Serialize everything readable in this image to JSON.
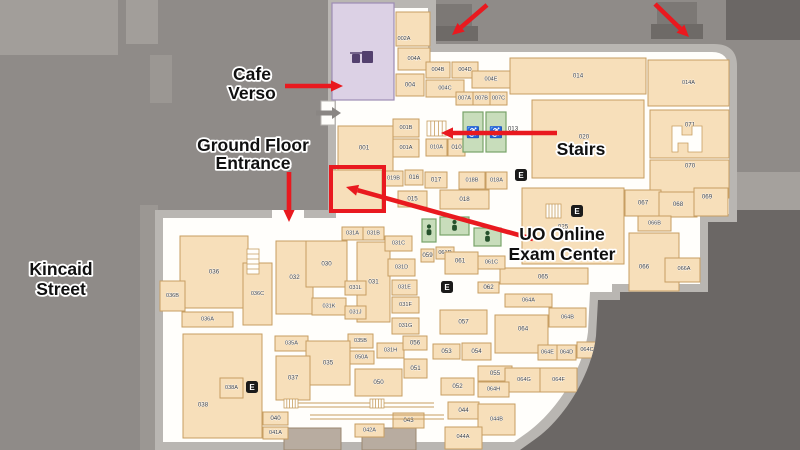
{
  "map": {
    "colors": {
      "street": "#8f8b88",
      "street_light": "#a29e9a",
      "sidewalk": "#9b9793",
      "dark": "#6b6765",
      "elbow": "#a5a19d",
      "wall": "#b9b6b2",
      "floor": "#fffefb",
      "room": "#f7dfba",
      "room_stroke": "#c79e62",
      "cafe": "#dcd1e5",
      "cafe_stroke": "#9d8cb5",
      "cafe_icon": "#53406e",
      "green": "#c8ddbb",
      "green_stroke": "#78a369",
      "green_icon": "#25512c",
      "dim": "#b8aca0",
      "dim_stroke": "#9b8871",
      "red": "#e9191f",
      "ink": "#101010",
      "room_ink": "#3c3c3c",
      "stoop_top": "#7c7875",
      "stoop_base": "#6e6a67",
      "gray_arrow": "#8a8683",
      "elevator": "#1b1b1b",
      "elevator_letter": "#ffffff"
    },
    "building": {
      "wall_path": "M328,0 L436,0 L436,44 L714,44 Q737,44 737,66 L737,222 L708,222 L708,292 L620,292 L620,300 L598,300 L596,336 C592,372 566,418 534,440 L520,450 L155,450 L155,210 L328,210 Z",
      "floor_path": "M336,8 L428,8 L428,52 L712,52 Q729,52 729,70 L729,214 L700,214 L700,284 L612,284 L612,292 L590,292 L588,332 C584,366 560,408 528,432 L514,442 L163,442 L163,218 L336,218 Z",
      "entrance_gap": [
        272,
        210,
        32,
        10
      ]
    },
    "bg_shapes": [
      [
        0,
        0,
        118,
        55,
        "street_light",
        "sidewalk-block"
      ],
      [
        126,
        0,
        32,
        44,
        "street_light",
        "sidewalk-block"
      ],
      [
        150,
        55,
        22,
        48,
        "sidewalk",
        "sidewalk-strip"
      ],
      [
        140,
        205,
        18,
        245,
        "sidewalk",
        "sidewalk-strip"
      ],
      [
        737,
        172,
        63,
        40,
        "elbow",
        "sidewalk-elbow"
      ],
      [
        726,
        0,
        74,
        40,
        "dark",
        "adjacent-building"
      ],
      [
        505,
        210,
        295,
        240,
        "dark",
        "adjacent-area"
      ]
    ],
    "entrance_stoops": [
      [
        434,
        4,
        38,
        23
      ],
      [
        428,
        26,
        50,
        15
      ],
      [
        657,
        2,
        40,
        23
      ],
      [
        651,
        24,
        52,
        15
      ]
    ],
    "rooms": [
      [
        "002A",
        396,
        12,
        34,
        34,
        404,
        39
      ],
      [
        "004A",
        398,
        48,
        32,
        22
      ],
      [
        "004",
        396,
        74,
        28,
        22
      ],
      [
        "004B",
        426,
        62,
        24,
        16
      ],
      [
        "004C",
        426,
        80,
        38,
        17
      ],
      [
        "004D",
        452,
        62,
        26,
        16
      ],
      [
        "004E",
        472,
        71,
        38,
        17
      ],
      [
        "007A",
        456,
        92,
        17,
        13
      ],
      [
        "007B",
        473,
        92,
        17,
        13
      ],
      [
        "007C",
        490,
        92,
        17,
        13
      ],
      [
        "014",
        510,
        58,
        136,
        36
      ],
      [
        "014A",
        648,
        60,
        81,
        46
      ],
      [
        "020",
        532,
        100,
        112,
        78,
        584,
        137
      ],
      [
        "071",
        650,
        110,
        79,
        48,
        690,
        125
      ],
      [
        "070",
        650,
        160,
        79,
        38,
        690,
        166
      ],
      [
        "067",
        625,
        190,
        36,
        26
      ],
      [
        "068",
        659,
        192,
        38,
        25
      ],
      [
        "069",
        694,
        188,
        34,
        28,
        707,
        197
      ],
      [
        "066B",
        638,
        216,
        33,
        15
      ],
      [
        "066",
        629,
        233,
        50,
        58,
        644,
        267
      ],
      [
        "066A",
        665,
        258,
        35,
        24,
        684,
        269
      ],
      [
        "025",
        522,
        188,
        102,
        76,
        563,
        227
      ],
      [
        "065",
        500,
        268,
        88,
        16,
        543,
        277
      ],
      [
        "001",
        338,
        126,
        55,
        48,
        364,
        148
      ],
      [
        "001B",
        393,
        119,
        26,
        18
      ],
      [
        "001A",
        393,
        139,
        26,
        18
      ],
      [
        "010A",
        426,
        139,
        21,
        17
      ],
      [
        "010",
        448,
        139,
        17,
        17
      ],
      [
        "019B",
        384,
        171,
        19,
        15
      ],
      [
        "016",
        405,
        170,
        18,
        15
      ],
      [
        "017",
        425,
        172,
        22,
        16
      ],
      [
        "018B",
        459,
        172,
        26,
        17
      ],
      [
        "018A",
        486,
        172,
        21,
        17
      ],
      [
        "015",
        398,
        191,
        29,
        16
      ],
      [
        "018",
        440,
        190,
        49,
        19
      ],
      [
        "",
        332,
        170,
        50,
        40
      ],
      [
        "036",
        180,
        236,
        68,
        72
      ],
      [
        "036B",
        160,
        281,
        25,
        30
      ],
      [
        "036C",
        243,
        263,
        29,
        62
      ],
      [
        "036A",
        182,
        312,
        51,
        15
      ],
      [
        "032",
        276,
        241,
        37,
        73
      ],
      [
        "030",
        306,
        241,
        41,
        46
      ],
      [
        "031A",
        342,
        227,
        21,
        13
      ],
      [
        "031B",
        363,
        227,
        21,
        13
      ],
      [
        "031",
        357,
        242,
        33,
        80
      ],
      [
        "031C",
        385,
        236,
        27,
        15
      ],
      [
        "031L",
        345,
        281,
        21,
        14
      ],
      [
        "031K",
        312,
        298,
        34,
        17
      ],
      [
        "031J",
        345,
        306,
        21,
        13
      ],
      [
        "031D",
        388,
        259,
        27,
        17
      ],
      [
        "031E",
        392,
        280,
        25,
        15
      ],
      [
        "031F",
        392,
        297,
        27,
        16
      ],
      [
        "031G",
        392,
        318,
        27,
        16
      ],
      [
        "031H",
        377,
        343,
        27,
        15
      ],
      [
        "035A",
        275,
        336,
        33,
        15
      ],
      [
        "035B",
        348,
        334,
        25,
        14
      ],
      [
        "050A",
        349,
        351,
        25,
        13
      ],
      [
        "035",
        306,
        341,
        44,
        44
      ],
      [
        "037",
        276,
        356,
        34,
        44
      ],
      [
        "050",
        355,
        369,
        47,
        27
      ],
      [
        "056",
        403,
        336,
        24,
        14
      ],
      [
        "051",
        404,
        359,
        23,
        19
      ],
      [
        "038",
        183,
        334,
        79,
        104,
        203,
        405
      ],
      [
        "038A",
        220,
        378,
        23,
        20
      ],
      [
        "040",
        263,
        412,
        25,
        13
      ],
      [
        "041A",
        263,
        427,
        25,
        12
      ],
      [
        "042A",
        355,
        424,
        29,
        13
      ],
      [
        "043",
        393,
        413,
        31,
        15
      ],
      [
        "053",
        433,
        344,
        27,
        15
      ],
      [
        "054",
        462,
        343,
        29,
        17
      ],
      [
        "057",
        440,
        310,
        47,
        24
      ],
      [
        "062",
        478,
        282,
        21,
        11
      ],
      [
        "059",
        421,
        249,
        13,
        13
      ],
      [
        "061D",
        436,
        247,
        18,
        12
      ],
      [
        "061",
        445,
        252,
        33,
        22,
        460,
        261
      ],
      [
        "061C",
        478,
        256,
        27,
        13
      ],
      [
        "064A",
        505,
        294,
        47,
        13
      ],
      [
        "064B",
        549,
        308,
        37,
        19
      ],
      [
        "064",
        495,
        315,
        53,
        38,
        523,
        329
      ],
      [
        "064E",
        538,
        345,
        19,
        15
      ],
      [
        "064D",
        557,
        345,
        19,
        15
      ],
      [
        "064C",
        577,
        342,
        20,
        16
      ],
      [
        "055",
        478,
        366,
        34,
        15
      ],
      [
        "064G",
        505,
        368,
        38,
        24
      ],
      [
        "064F",
        540,
        368,
        37,
        24
      ],
      [
        "052",
        441,
        378,
        33,
        17
      ],
      [
        "064H",
        478,
        382,
        31,
        15
      ],
      [
        "044",
        448,
        402,
        31,
        17
      ],
      [
        "044B",
        478,
        404,
        37,
        31
      ],
      [
        "044A",
        445,
        427,
        37,
        22,
        463,
        437
      ]
    ],
    "cafe_room": {
      "x": 332,
      "y": 3,
      "w": 62,
      "h": 97
    },
    "dim_rooms": [
      [
        284,
        428,
        57,
        22
      ],
      [
        362,
        428,
        54,
        22
      ]
    ],
    "green_rooms": [
      [
        463,
        112,
        20,
        40,
        "wheelchair"
      ],
      [
        486,
        112,
        20,
        40,
        "wheelchair"
      ],
      [
        422,
        219,
        14,
        23,
        "person"
      ],
      [
        440,
        217,
        29,
        18,
        "person"
      ],
      [
        474,
        228,
        27,
        18,
        "person"
      ]
    ],
    "standalone_labels": [
      [
        "013",
        513,
        129
      ]
    ],
    "elevators": [
      [
        521,
        175
      ],
      [
        577,
        211
      ],
      [
        447,
        287
      ],
      [
        252,
        387
      ]
    ],
    "elevator_letter": "E",
    "stairs_icons": [
      [
        427,
        121,
        19,
        15
      ],
      [
        546,
        204,
        15,
        14
      ],
      [
        247,
        249,
        12,
        25
      ],
      [
        284,
        399,
        14,
        9
      ],
      [
        370,
        399,
        14,
        9
      ]
    ],
    "ramp_lines": [
      [
        298,
        403,
        434,
        403
      ],
      [
        298,
        407,
        434,
        407
      ],
      [
        310,
        415,
        444,
        415
      ],
      [
        310,
        419,
        444,
        419
      ]
    ],
    "lightwell_points": "672,126 682,126 682,135 692,135 692,126 702,126 702,152 688,152 688,143 678,143 678,152 672,152",
    "gray_entrance_arrow": {
      "x1": 316,
      "y1": 113,
      "x2": 341,
      "y2": 113
    },
    "white_nub": [
      321,
      101,
      14,
      24
    ],
    "highlight_rect": [
      331,
      167,
      53,
      44
    ],
    "red_arrows": [
      [
        487,
        5,
        452,
        35
      ],
      [
        655,
        4,
        689,
        37
      ],
      [
        285,
        86,
        343,
        86
      ],
      [
        289,
        172,
        289,
        222
      ],
      [
        557,
        133,
        441,
        133
      ],
      [
        533,
        239,
        346,
        187
      ]
    ],
    "annotations": [
      {
        "name": "cafe-verso",
        "lines": [
          "Cafe",
          "Verso"
        ],
        "x": 252,
        "y": 74,
        "lh": 19
      },
      {
        "name": "ground-floor-entrance",
        "lines": [
          "Ground Floor",
          "Entrance"
        ],
        "x": 253,
        "y": 145,
        "lh": 18
      },
      {
        "name": "stairs",
        "lines": [
          "Stairs"
        ],
        "x": 581,
        "y": 149,
        "lh": 18
      },
      {
        "name": "uo-online-exam-center",
        "lines": [
          "UO Online",
          "Exam Center"
        ],
        "x": 562,
        "y": 234,
        "lh": 20
      },
      {
        "name": "kincaid-street",
        "lines": [
          "Kincaid",
          "Street"
        ],
        "x": 61,
        "y": 269,
        "lh": 20
      }
    ]
  }
}
